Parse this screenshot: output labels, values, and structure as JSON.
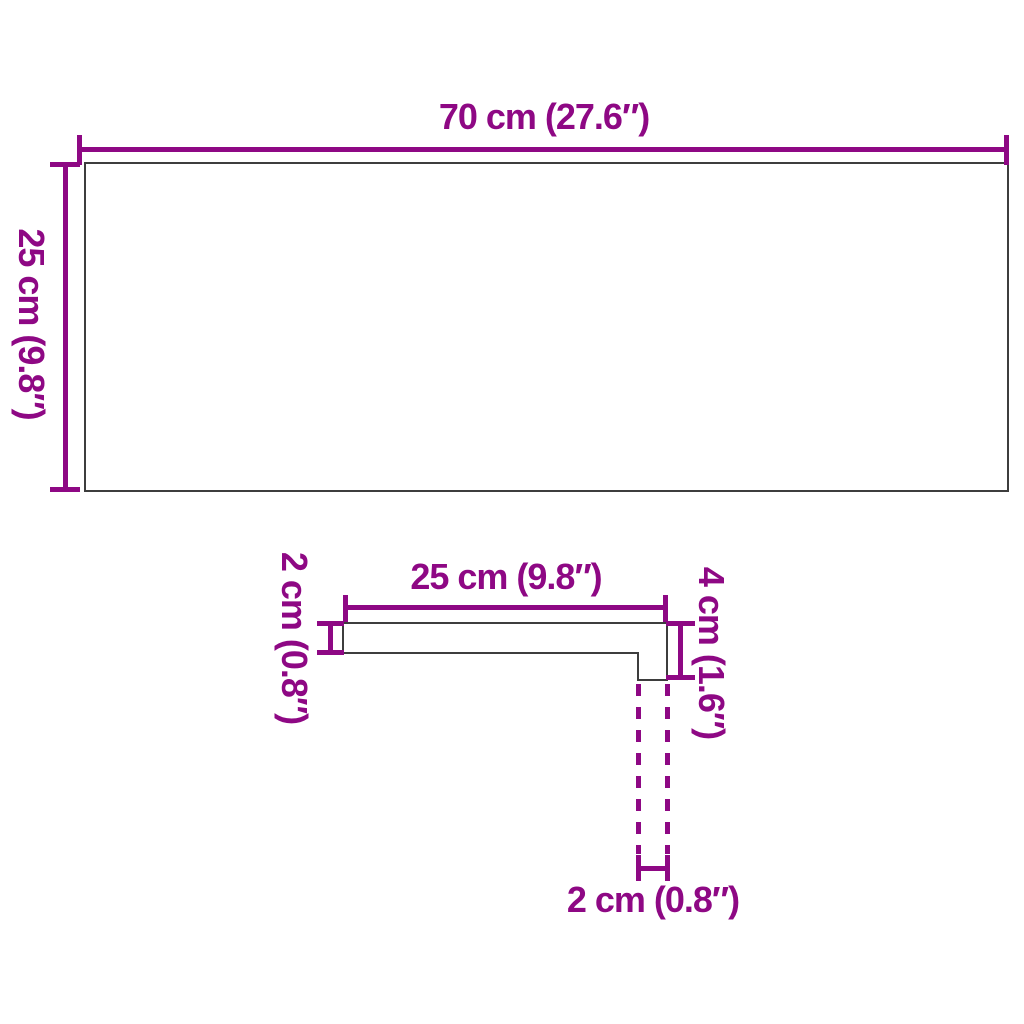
{
  "image_type": "product dimension diagram",
  "colors": {
    "dimension_lines": "#8e0884",
    "object_outline": "#3d3d3d",
    "background": "#ffffff"
  },
  "top_view": {
    "width_label": "70 cm (27.6″)",
    "depth_label": "25 cm (9.8″)"
  },
  "profile_view": {
    "length_label": "25 cm (9.8″)",
    "thickness_label": "2 cm (0.8″)",
    "height_label": "4 cm (1.6″)",
    "nose_width_label": "2 cm (0.8″)"
  }
}
